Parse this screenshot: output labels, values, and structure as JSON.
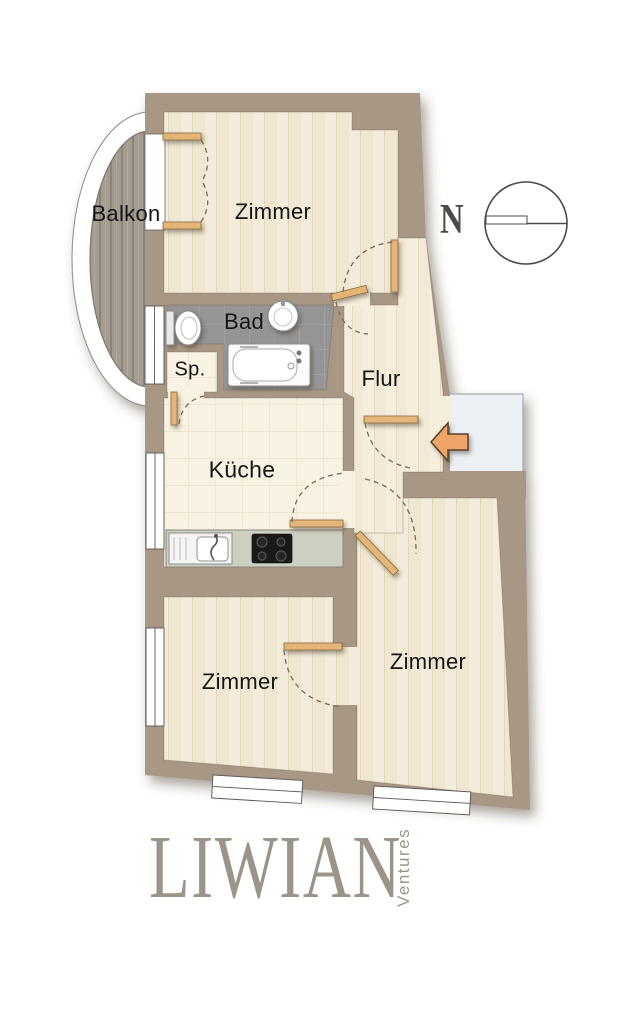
{
  "rooms": {
    "balkon": "Balkon",
    "zimmer_top": "Zimmer",
    "bad": "Bad",
    "sp": "Sp.",
    "flur": "Flur",
    "kueche": "Küche",
    "zimmer_left": "Zimmer",
    "zimmer_right": "Zimmer"
  },
  "compass": {
    "north_label": "N"
  },
  "branding": {
    "name": "LIWIAN",
    "subtitle": "Ventures"
  },
  "icons": {
    "entrance": "entrance-arrow-icon",
    "compass": "compass-icon",
    "fixtures": [
      "toilet",
      "wash-basin",
      "bathtub",
      "kitchen-sink",
      "cooktop"
    ]
  },
  "colors": {
    "wall": "#a99786",
    "floor_plank": "#f3ecda",
    "floor_flur": "#f6eedd",
    "kitchen_tile": "#f8f2e2",
    "bath_tile": "#959595",
    "balcony_wood": "#a49b91",
    "landing": "#eceff3",
    "arrow": "#f0a468",
    "arrow_outline": "#55402c",
    "door_leaf": "#e3b678",
    "swing_arc": "#7b6b57",
    "window": "#ffffff",
    "label_text": "#151515",
    "logo": "#9b948a",
    "compass": "#4a4a4a"
  }
}
